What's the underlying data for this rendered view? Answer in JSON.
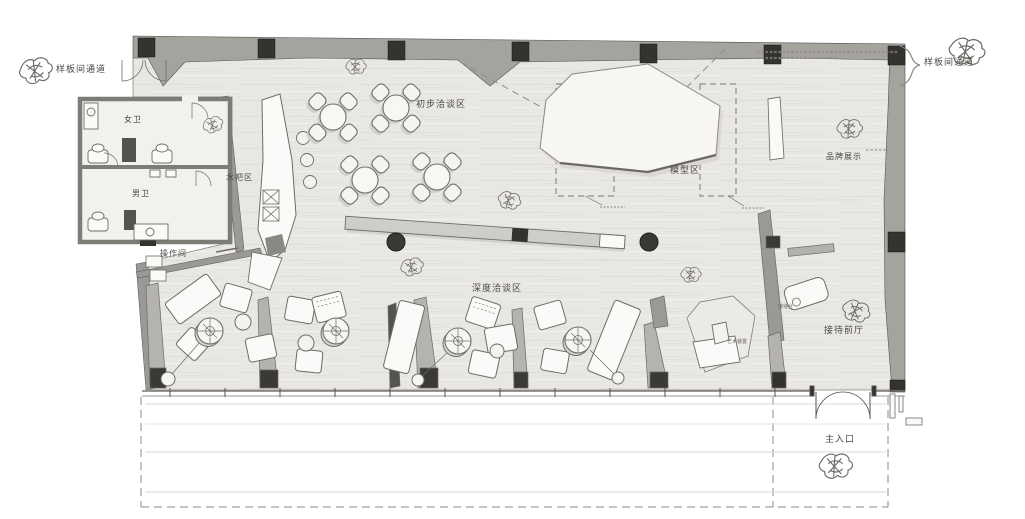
{
  "floorplan": {
    "corridors": {
      "left": "样板间通道",
      "right": "样板间通道"
    },
    "rooms": {
      "womens_restroom": "女卫",
      "mens_restroom": "男卫",
      "operation_room": "操作间"
    },
    "zones": {
      "water_bar": "水吧区",
      "preliminary_meeting": "初步洽谈区",
      "model_area": "模型区",
      "brand_display": "品牌展示",
      "deep_meeting": "深度洽谈区",
      "reception_hall": "接待前厅",
      "main_entrance": "主入口"
    },
    "furniture_labels": {
      "reception_desk": "接待台",
      "art_installation": "艺术装置"
    },
    "colors": {
      "wall": "#a5a39e",
      "column": "#34332f",
      "floor": "#e9e7e3",
      "furniture_fill": "#fbfaf8",
      "ink": "#6e6c67",
      "dashed": "#8d8b86"
    }
  }
}
